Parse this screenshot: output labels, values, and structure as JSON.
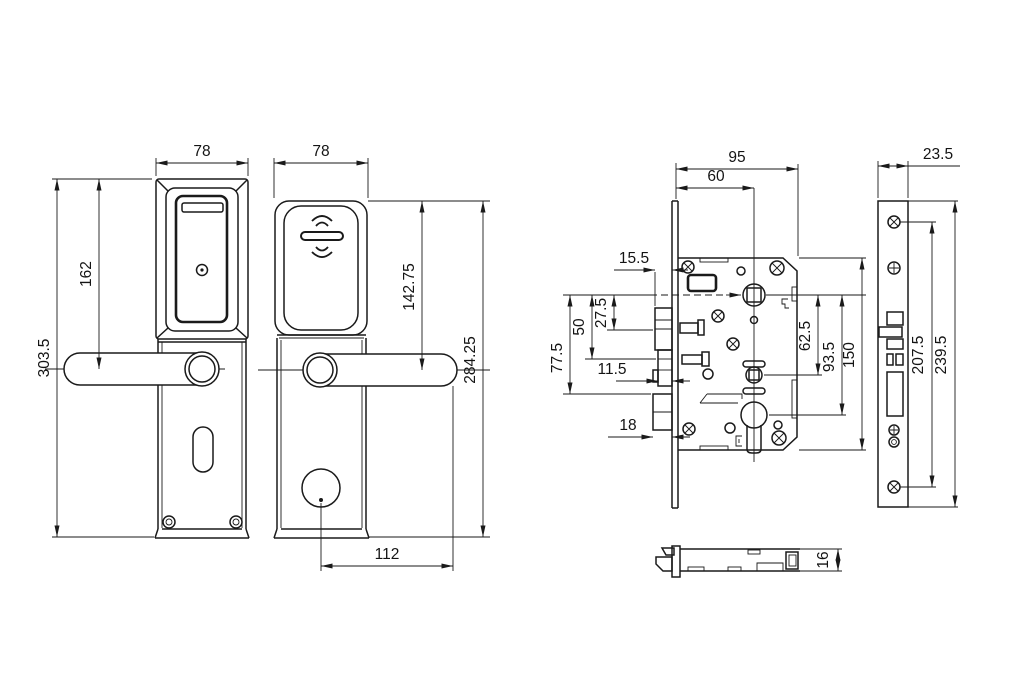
{
  "title": "Smart door lock dimensional drawing",
  "colors": {
    "line": "#1a1a1a",
    "background": "#ffffff"
  },
  "dims": {
    "interior_view": {
      "top_width": "78",
      "top_to_handle": "162",
      "overall_height": "303.5"
    },
    "exterior_view": {
      "top_width": "78",
      "top_to_handle": "142.75",
      "overall_height": "284.25",
      "handle_span": "112"
    },
    "lock_body": {
      "case_width": "95",
      "backset": "60",
      "latch_projection": "15.5",
      "handle_to_latch": "27.5",
      "handle_to_deadbolt": "50",
      "handle_to_aux": "77.5",
      "deadbolt_projection": "11.5",
      "aux_projection": "18",
      "hub_spacing": "62.5",
      "cylinder_spacing": "93.5",
      "case_height": "150"
    },
    "faceplate_view": {
      "width": "23.5",
      "screw_spacing": "207.5",
      "length": "239.5"
    },
    "profile_view": {
      "thickness": "16"
    }
  }
}
